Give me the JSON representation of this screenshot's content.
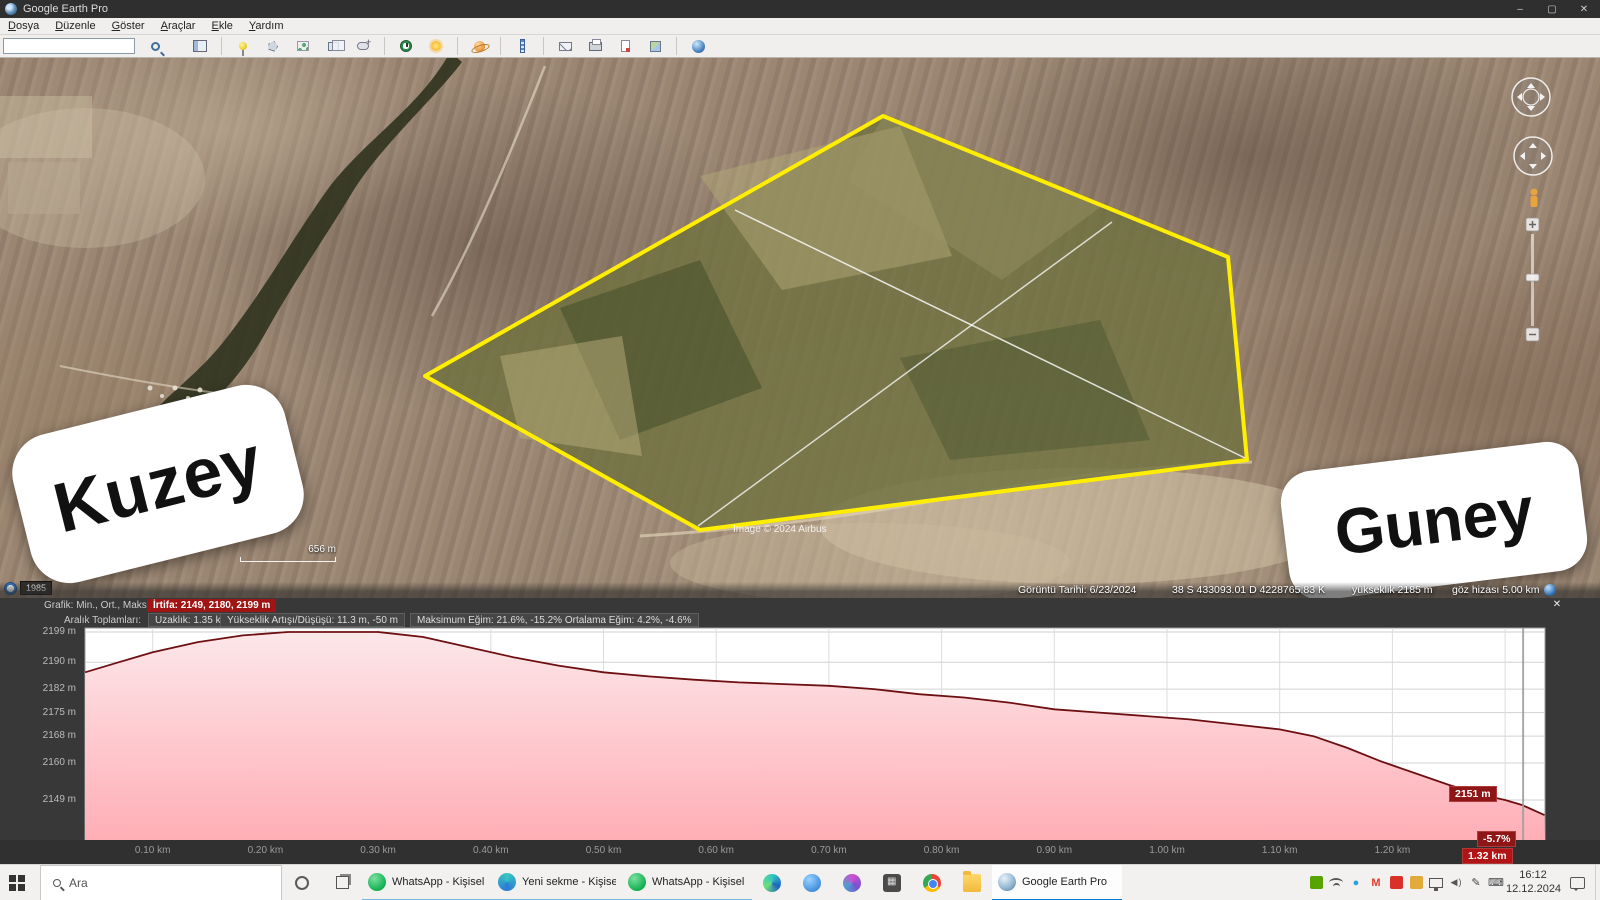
{
  "window": {
    "title": "Google Earth Pro",
    "minimize": "–",
    "maximize": "▢",
    "close": "✕"
  },
  "menu": {
    "items": [
      "Dosya",
      "Düzenle",
      "Göster",
      "Araçlar",
      "Ekle",
      "Yardım"
    ]
  },
  "toolbar": {
    "search_value": "",
    "icons": [
      "sidebar",
      "add-placemark",
      "add-polygon",
      "add-path",
      "add-image-overlay",
      "record-tour",
      "historical-imagery",
      "sunlight",
      "planets",
      "ruler",
      "email",
      "print",
      "save-image",
      "view-in-google-maps",
      "earth"
    ]
  },
  "map": {
    "sticker_north": "Kuzey",
    "sticker_south": "Guney",
    "scale_text": "656 m",
    "history_year": "1985",
    "attribution": "Image © 2024 Airbus",
    "status": {
      "date": "Görüntü Tarihi: 6/23/2024",
      "coords": "38 S 433093.01 D 4228765.83 K",
      "elevation": "yükseklik 2185 m",
      "eye_alt": "göz hizası 5.00 km"
    },
    "polygon_color": "#ffee00"
  },
  "profile": {
    "graph_label": "Grafik: Min., Ort., Maks.",
    "elevation_summary": "İrtifa: 2149, 2180, 2199 m",
    "totals_label": "Aralık Toplamları:",
    "distance": "Uzaklık: 1.35 km",
    "gain_loss": "Yükseklik Artışı/Düşüşü: 11.3 m, -50 m",
    "max_slope": "Maksimum Eğim: 21.6%, -15.2%",
    "avg_slope": "Ortalama Eğim: 4.2%, -4.6%",
    "close_label": "✕",
    "cursor_elevation": "2151 m",
    "cursor_slope": "-5.7%",
    "cursor_distance": "1.32 km",
    "highlight_color": "#a01414"
  },
  "chart_data": {
    "type": "area",
    "title": "İrtifa profili",
    "xlabel": "km",
    "ylabel": "m",
    "x": [
      0.04,
      0.07,
      0.1,
      0.14,
      0.18,
      0.22,
      0.26,
      0.3,
      0.34,
      0.38,
      0.42,
      0.46,
      0.5,
      0.54,
      0.58,
      0.62,
      0.66,
      0.7,
      0.74,
      0.78,
      0.82,
      0.86,
      0.9,
      0.94,
      0.98,
      1.02,
      1.06,
      1.1,
      1.13,
      1.16,
      1.19,
      1.22,
      1.25,
      1.28,
      1.3,
      1.315,
      1.335
    ],
    "y": [
      2187,
      2190,
      2193,
      2196,
      2198,
      2199,
      2199,
      2199,
      2197.5,
      2194.5,
      2191.5,
      2189,
      2187,
      2185.8,
      2184.8,
      2184,
      2183.5,
      2183,
      2182,
      2180.5,
      2179.5,
      2178,
      2176,
      2175,
      2174,
      2173,
      2171.5,
      2170,
      2168,
      2164.5,
      2160.5,
      2157,
      2153.5,
      2150.5,
      2149,
      2147.5,
      2144.5
    ],
    "yticks": [
      {
        "value": 2199,
        "label": "2199 m"
      },
      {
        "value": 2190,
        "label": "2190 m"
      },
      {
        "value": 2182,
        "label": "2182 m"
      },
      {
        "value": 2175,
        "label": "2175 m"
      },
      {
        "value": 2168,
        "label": "2168 m"
      },
      {
        "value": 2160,
        "label": "2160 m"
      },
      {
        "value": 2149,
        "label": "2149 m"
      }
    ],
    "xticks": [
      {
        "value": 0.1,
        "label": "0.10 km"
      },
      {
        "value": 0.2,
        "label": "0.20 km"
      },
      {
        "value": 0.3,
        "label": "0.30 km"
      },
      {
        "value": 0.4,
        "label": "0.40 km"
      },
      {
        "value": 0.5,
        "label": "0.50 km"
      },
      {
        "value": 0.6,
        "label": "0.60 km"
      },
      {
        "value": 0.7,
        "label": "0.70 km"
      },
      {
        "value": 0.8,
        "label": "0.80 km"
      },
      {
        "value": 0.9,
        "label": "0.90 km"
      },
      {
        "value": 1.0,
        "label": "1.00 km"
      },
      {
        "value": 1.1,
        "label": "1.10 km"
      },
      {
        "value": 1.2,
        "label": "1.20 km"
      }
    ],
    "xlim": [
      0.04,
      1.335
    ],
    "ylim": [
      2137,
      2200
    ],
    "cursor_x": 1.316,
    "grid": true,
    "line_color": "#6e0f12",
    "fill_top": "#fce8ea",
    "fill_bottom": "#ffaeb6"
  },
  "taskbar": {
    "search_placeholder": "Ara",
    "apps": [
      {
        "label": "WhatsApp - Kişisel ...",
        "icon": "whatsapp"
      },
      {
        "label": "Yeni sekme - Kişisel...",
        "icon": "edgetab"
      },
      {
        "label": "WhatsApp - Kişisel ...",
        "icon": "whatsapp"
      }
    ],
    "icon_buttons": [
      "edge",
      "blue",
      "paint",
      "calc",
      "chrome",
      "folder"
    ],
    "active_app": {
      "label": "Google Earth Pro",
      "icon": "ge"
    },
    "tray_icons": [
      "nvidia",
      "wifi",
      "blue-dot",
      "gmail",
      "adobe",
      "card",
      "display",
      "volume",
      "pen",
      "keyboard"
    ],
    "clock": {
      "time": "16:12",
      "date": "12.12.2024"
    }
  }
}
